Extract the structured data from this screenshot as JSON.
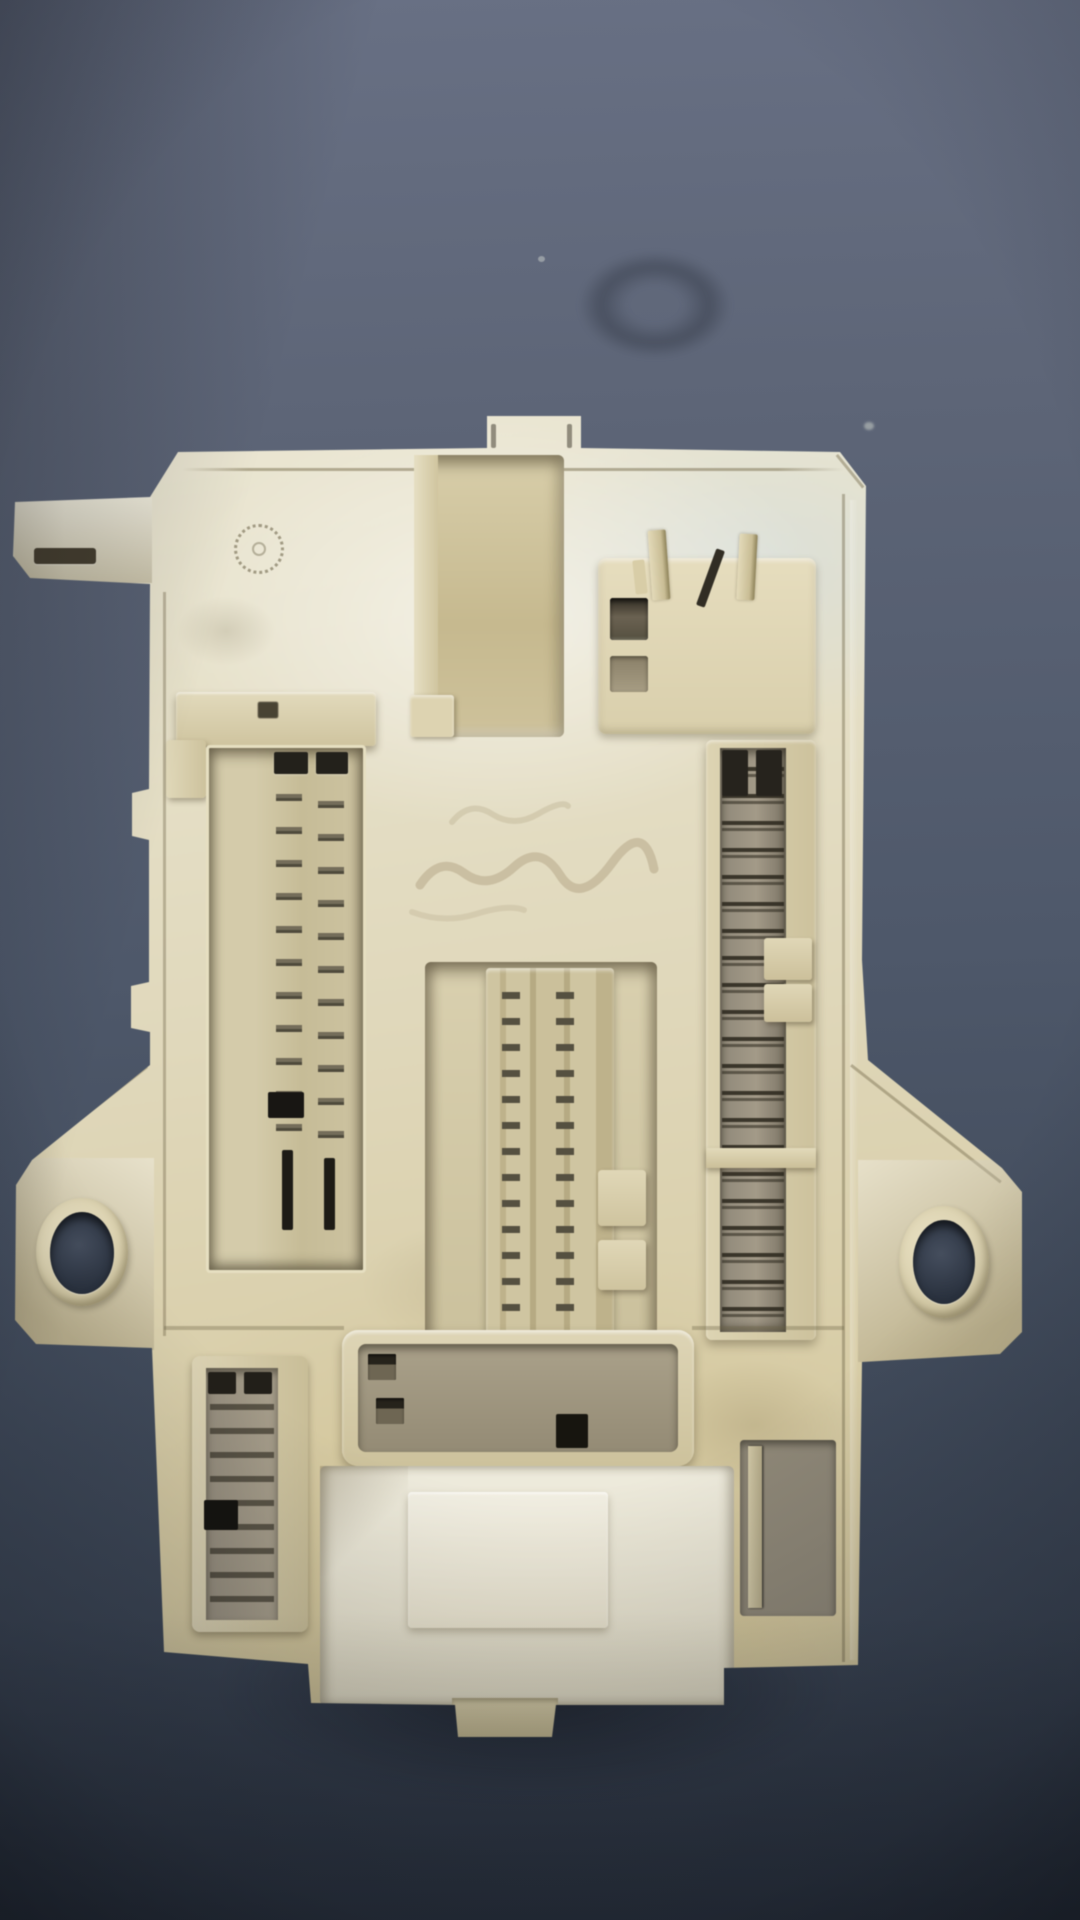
{
  "scene": {
    "type": "photograph",
    "subject": "beige automotive interior fuse box / body control module photographed from above on a dark blue-gray surface",
    "orientation": "portrait",
    "visible_text": "none — only a faint illegible handwritten marking on the center plate and a small molded circular symbol near the top-left"
  },
  "colors": {
    "bg_top": "#687084",
    "bg_upper": "#5d6577",
    "bg_mid": "#4e586a",
    "bg_low": "#3f4959",
    "bg_bottom": "#333c4a",
    "plastic_bright": "#efebdb",
    "plastic_light": "#e8e3cc",
    "plastic_mid": "#ddd4b2",
    "plastic_dark": "#d2c69c",
    "plastic_shadow": "#a89c74",
    "crevice": "#6e6550",
    "slot_dark": "#23211b",
    "metal": "#938b76",
    "metal_dark": "#6b6452",
    "bluish_tint": "#d7dee2",
    "hole_dark": "#454e5e"
  },
  "counts": {
    "connA_blades": 4,
    "connB_row1_slots": 4,
    "connB_row2_slots": 4,
    "connC_ledge_notches": 3,
    "connH_row1_slots": 8,
    "connH_row2_slots": 7,
    "skirt_fins": 3
  },
  "components": {
    "top_tab": "small rectangular tab on top edge",
    "top_center_connector": "recessed cavity with four horizontal blade terminals",
    "top_right_connector": "socket block with two rows of slots and two upright blade pins, one bent dark pin",
    "left_connector": "tall two-column micro-pin connector with black slots at top and bottom",
    "center_connector": "ribbed vertical connector in recess with two pin columns",
    "right_connector": "long gray pin strip connector split by a divider",
    "bottom_wide_connector": "rounded-rectangle connector with two rows of pin slots and one black keyed slot",
    "bottom_left_connector": "small vertical gray pin connector",
    "mounting_ear_left": "flange with round mounting hole",
    "mounting_ear_right": "flange with round mounting hole",
    "bottom_shroud": "bright white lower connector shroud with raised plateau and bottom tab"
  }
}
